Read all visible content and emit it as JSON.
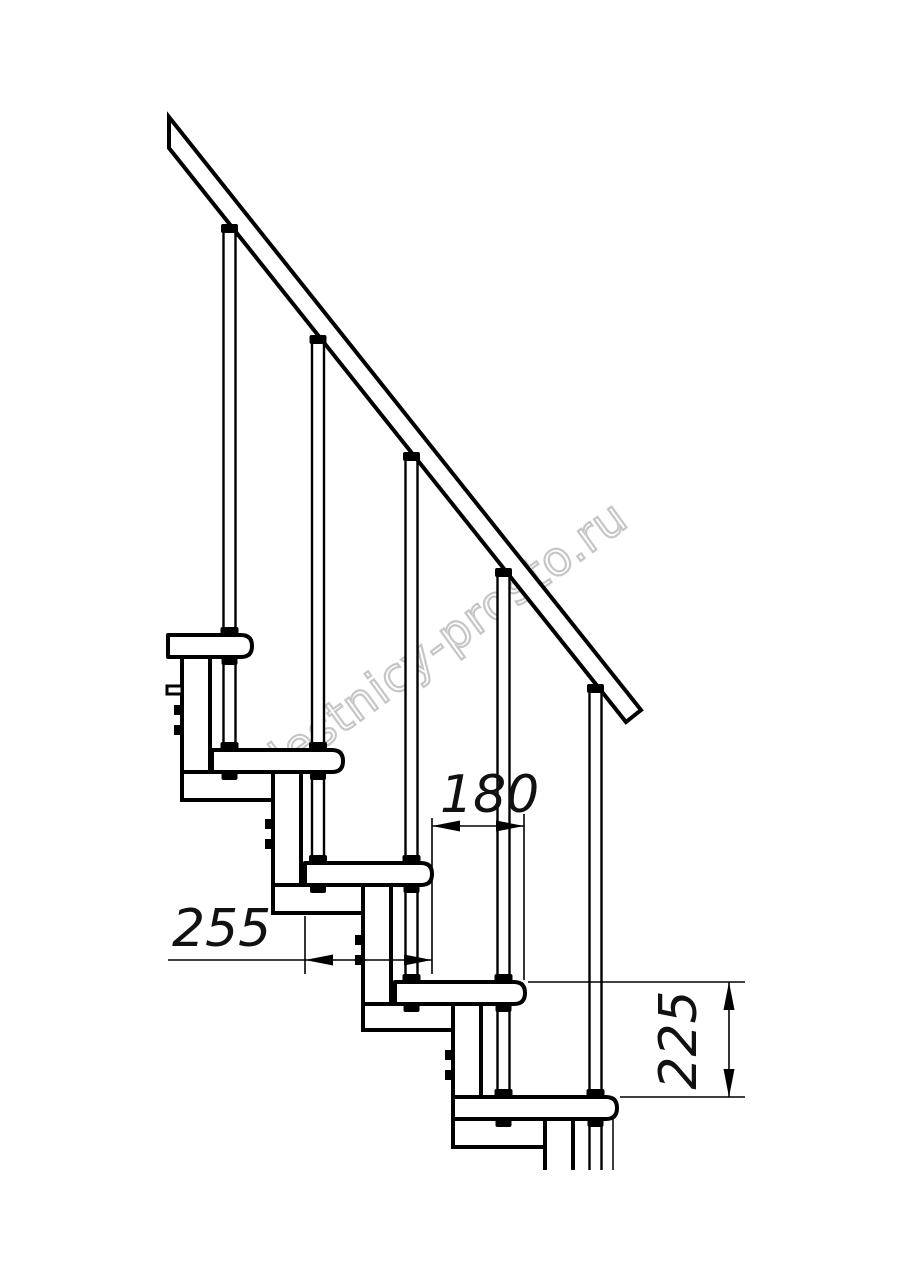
{
  "drawing": {
    "kind": "modular-staircase-side-view",
    "line_color": "#000000",
    "background_color": "#ffffff",
    "watermark": {
      "text": "lestnicy-prosto.ru",
      "color": "#c6c6c6"
    },
    "dimensions": {
      "tread_depth": {
        "value": "255"
      },
      "going": {
        "value": "180"
      },
      "rise": {
        "value": "225"
      }
    }
  }
}
